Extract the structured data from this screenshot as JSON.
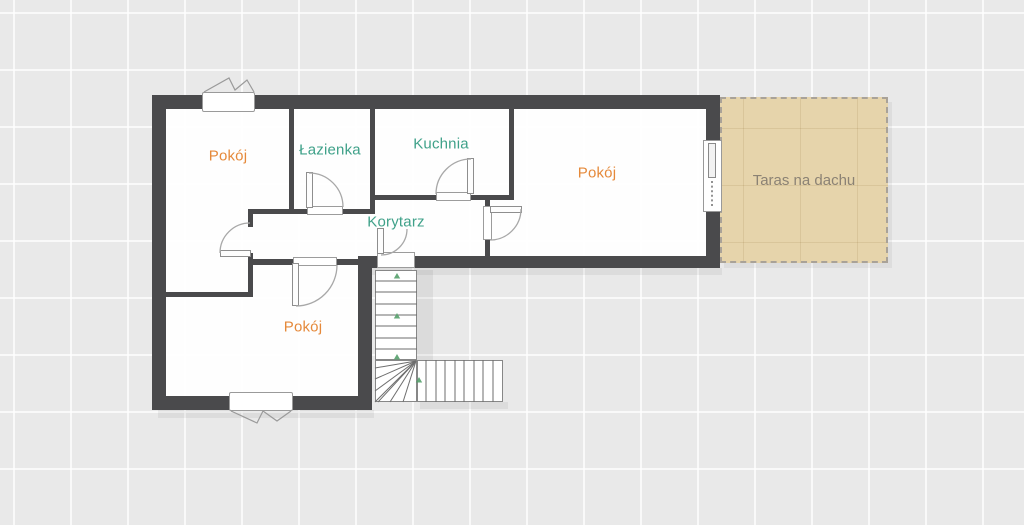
{
  "plan": {
    "kind": "floor-plan",
    "language": "pl"
  },
  "colors": {
    "background": "#e9e9e9",
    "wall": "#4a4a4c",
    "room_fill": "#fdfdfd",
    "terrace_fill": "#e6d4ab",
    "label_orange": "#e5893a",
    "label_teal": "#3fa189",
    "label_terrace": "#8b8274",
    "marker_green": "#55a06b"
  },
  "labels": {
    "room_top_left": {
      "text": "Pokój"
    },
    "bathroom": {
      "text": "Łazienka"
    },
    "kitchen": {
      "text": "Kuchnia"
    },
    "room_right": {
      "text": "Pokój"
    },
    "corridor": {
      "text": "Korytarz"
    },
    "room_bottom": {
      "text": "Pokój"
    },
    "terrace": {
      "text": "Taras na dachu"
    }
  },
  "geometry": {
    "shadows": [
      [
        158,
        410,
        216,
        8
      ],
      [
        364,
        268,
        358,
        7
      ],
      [
        420,
        402,
        88,
        7
      ]
    ],
    "fills": [
      [
        166,
        109,
        540,
        147
      ],
      [
        166,
        256,
        192,
        140
      ]
    ],
    "walls_thick": [
      [
        152,
        95,
        568,
        14
      ],
      [
        152,
        95,
        14,
        315
      ],
      [
        152,
        396,
        220,
        14
      ],
      [
        358,
        262,
        14,
        148
      ],
      [
        358,
        256,
        19,
        12
      ],
      [
        415,
        256,
        305,
        12
      ],
      [
        706,
        95,
        14,
        173
      ]
    ],
    "walls_thin": [
      [
        289,
        109,
        5,
        104
      ],
      [
        370,
        109,
        5,
        104
      ],
      [
        250,
        209,
        57,
        5
      ],
      [
        343,
        209,
        32,
        5
      ],
      [
        375,
        195,
        61,
        5
      ],
      [
        471,
        195,
        43,
        5
      ],
      [
        509,
        109,
        5,
        91
      ],
      [
        485,
        200,
        5,
        8
      ],
      [
        485,
        238,
        5,
        18
      ],
      [
        248,
        209,
        5,
        18
      ],
      [
        248,
        253,
        5,
        44
      ],
      [
        166,
        292,
        87,
        5
      ],
      [
        253,
        259,
        40,
        6
      ],
      [
        337,
        259,
        26,
        6
      ]
    ],
    "thresholds": [
      [
        307,
        206,
        36,
        9
      ],
      [
        436,
        192,
        35,
        9
      ],
      [
        483,
        206,
        9,
        34
      ],
      [
        293,
        257,
        44,
        9
      ],
      [
        377,
        252,
        38,
        16
      ]
    ],
    "leaves": [
      [
        306,
        172,
        7,
        36
      ],
      [
        467,
        158,
        7,
        36
      ],
      [
        490,
        206,
        32,
        7
      ],
      [
        220,
        250,
        31,
        7
      ],
      [
        292,
        263,
        7,
        43
      ],
      [
        377,
        228,
        7,
        26
      ]
    ],
    "arcs": [
      {
        "cx": 309,
        "cy": 207,
        "r": 34,
        "a0": 270,
        "a1": 360,
        "sw": 1
      },
      {
        "cx": 471,
        "cy": 194,
        "r": 35,
        "a0": 180,
        "a1": 270,
        "sw": 1
      },
      {
        "cx": 490,
        "cy": 209,
        "r": 31,
        "a0": 0,
        "a1": 90,
        "sw": 1
      },
      {
        "cx": 250,
        "cy": 253,
        "r": 30,
        "a0": 180,
        "a1": 270,
        "sw": 1
      },
      {
        "cx": 296,
        "cy": 265,
        "r": 41,
        "a0": 0,
        "a1": 90,
        "sw": 1
      },
      {
        "cx": 381,
        "cy": 229,
        "r": 26,
        "a0": 90,
        "a1": 0,
        "sw": 0
      }
    ],
    "windows": [
      [
        202,
        92,
        53,
        20
      ],
      [
        229,
        392,
        64,
        19
      ]
    ],
    "window_vees": [
      [
        [
          204,
          92
        ],
        [
          229,
          78
        ],
        [
          235,
          90
        ],
        [
          247,
          80
        ],
        [
          254,
          92
        ]
      ],
      [
        [
          231,
          411
        ],
        [
          257,
          423
        ],
        [
          263,
          411
        ],
        [
          277,
          421
        ],
        [
          291,
          411
        ]
      ]
    ],
    "balcony_door": {
      "frame": [
        703,
        140,
        19,
        72
      ],
      "leaf": [
        708,
        143,
        8,
        35
      ],
      "dots": [
        712,
        181,
        712,
        208
      ]
    },
    "stairs": {
      "shade": [
        417,
        270,
        16,
        90
      ],
      "flights": [
        [
          375,
          270,
          42,
          90
        ],
        [
          375,
          360,
          42,
          42
        ],
        [
          417,
          360,
          86,
          42
        ]
      ],
      "treads_h": [
        [
          375,
          281,
          417,
          281
        ],
        [
          375,
          292,
          417,
          292
        ],
        [
          375,
          304,
          417,
          304
        ],
        [
          375,
          315,
          417,
          315
        ],
        [
          375,
          326,
          417,
          326
        ],
        [
          375,
          338,
          417,
          338
        ],
        [
          375,
          349,
          417,
          349
        ]
      ],
      "treads_v": [
        [
          426,
          360,
          426,
          402
        ],
        [
          436,
          360,
          436,
          402
        ],
        [
          445,
          360,
          445,
          402
        ],
        [
          455,
          360,
          455,
          402
        ],
        [
          464,
          360,
          464,
          402
        ],
        [
          474,
          360,
          474,
          402
        ],
        [
          483,
          360,
          483,
          402
        ],
        [
          493,
          360,
          493,
          402
        ]
      ],
      "fan": [
        [
          416,
          361,
          375,
          368
        ],
        [
          416,
          361,
          375,
          379
        ],
        [
          416,
          361,
          375,
          391
        ],
        [
          416,
          361,
          375,
          402
        ],
        [
          416,
          361,
          378,
          402
        ],
        [
          416,
          361,
          390,
          402
        ],
        [
          416,
          361,
          403,
          402
        ]
      ],
      "markers": [
        [
          397,
          276
        ],
        [
          397,
          316
        ],
        [
          397,
          357
        ],
        [
          419,
          380
        ]
      ]
    }
  }
}
